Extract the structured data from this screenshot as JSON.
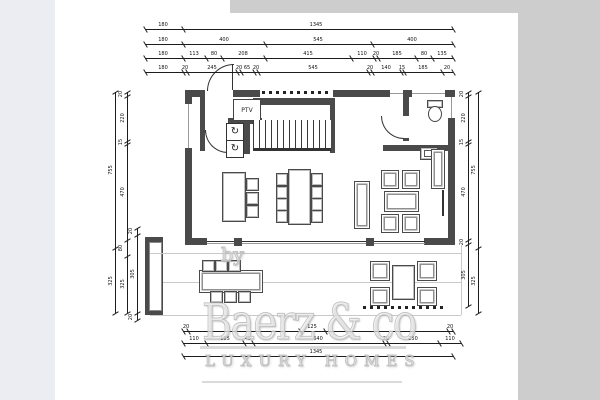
{
  "watermark": {
    "by": "by",
    "brand": "Baerz & co",
    "tagline": "LUXURY HOMES"
  },
  "plan_labels": {
    "ptv": "PTV"
  },
  "icons": {
    "appliance": "↻"
  },
  "colors": {
    "wall": "#4a4a4a",
    "paper": "#ffffff",
    "canvas": "#cdcdcd",
    "side_panel": "#ecedf2",
    "dimension": "#1c1c1c",
    "watermark": "#c2c2c2"
  },
  "dimensions": {
    "horizontal": [
      {
        "y": 29,
        "x1": 145,
        "x2": 453,
        "ticks": [
          145,
          183,
          453
        ],
        "labels": [
          {
            "x": 163,
            "t": "180"
          },
          {
            "x": 316,
            "t": "1345"
          }
        ]
      },
      {
        "y": 44,
        "x1": 145,
        "x2": 453,
        "ticks": [
          145,
          183,
          265,
          372,
          453
        ],
        "labels": [
          {
            "x": 163,
            "t": "180"
          },
          {
            "x": 224,
            "t": "400"
          },
          {
            "x": 318,
            "t": "545"
          },
          {
            "x": 412,
            "t": "400"
          }
        ]
      },
      {
        "y": 58,
        "x1": 145,
        "x2": 453,
        "ticks": [
          145,
          183,
          206,
          222,
          265,
          351,
          374,
          378,
          416,
          432,
          453
        ],
        "labels": [
          {
            "x": 163,
            "t": "180"
          },
          {
            "x": 194,
            "t": "113"
          },
          {
            "x": 214,
            "t": "80"
          },
          {
            "x": 243,
            "t": "208"
          },
          {
            "x": 308,
            "t": "415"
          },
          {
            "x": 362,
            "t": "110"
          },
          {
            "x": 376,
            "t": "20"
          },
          {
            "x": 397,
            "t": "185"
          },
          {
            "x": 424,
            "t": "80"
          },
          {
            "x": 442,
            "t": "135"
          }
        ]
      },
      {
        "y": 72,
        "x1": 145,
        "x2": 453,
        "ticks": [
          145,
          183,
          187,
          237,
          241,
          254,
          258,
          368,
          372,
          401,
          404,
          442,
          453
        ],
        "labels": [
          {
            "x": 163,
            "t": "180"
          },
          {
            "x": 185,
            "t": "20"
          },
          {
            "x": 212,
            "t": "245"
          },
          {
            "x": 239,
            "t": "20"
          },
          {
            "x": 247,
            "t": "65"
          },
          {
            "x": 256,
            "t": "20"
          },
          {
            "x": 313,
            "t": "545"
          },
          {
            "x": 370,
            "t": "20"
          },
          {
            "x": 386,
            "t": "140"
          },
          {
            "x": 402,
            "t": "15"
          },
          {
            "x": 423,
            "t": "185"
          },
          {
            "x": 447,
            "t": "20"
          }
        ]
      },
      {
        "y": 331,
        "x1": 183,
        "x2": 453,
        "ticks": [
          183,
          188,
          300,
          325,
          448,
          453
        ],
        "labels": [
          {
            "x": 186,
            "t": "20"
          },
          {
            "x": 312,
            "t": "125"
          },
          {
            "x": 450,
            "t": "20"
          }
        ]
      },
      {
        "y": 343,
        "x1": 183,
        "x2": 461,
        "ticks": [
          183,
          206,
          244,
          253,
          384,
          388,
          439,
          461
        ],
        "labels": [
          {
            "x": 194,
            "t": "110"
          },
          {
            "x": 225,
            "t": "185"
          },
          {
            "x": 248,
            "t": "45"
          },
          {
            "x": 318,
            "t": "640"
          },
          {
            "x": 386,
            "t": "20"
          },
          {
            "x": 413,
            "t": "250"
          },
          {
            "x": 450,
            "t": "110"
          }
        ]
      },
      {
        "y": 356,
        "x1": 183,
        "x2": 453,
        "ticks": [
          183,
          453
        ],
        "labels": [
          {
            "x": 316,
            "t": "1345"
          }
        ]
      }
    ],
    "vertical": [
      {
        "x": 115,
        "y1": 92,
        "y2": 313,
        "ticks": [
          92,
          248,
          313
        ],
        "labels": [
          {
            "y": 170,
            "t": "755"
          },
          {
            "y": 281,
            "t": "325"
          }
        ]
      },
      {
        "x": 127,
        "y1": 92,
        "y2": 313,
        "ticks": [
          92,
          96,
          141,
          144,
          240,
          256,
          313
        ],
        "labels": [
          {
            "y": 94,
            "t": "20"
          },
          {
            "y": 118,
            "t": "220"
          },
          {
            "y": 142,
            "t": "15"
          },
          {
            "y": 192,
            "t": "470"
          },
          {
            "y": 248,
            "t": "80"
          },
          {
            "y": 284,
            "t": "325"
          }
        ]
      },
      {
        "x": 137,
        "y1": 228,
        "y2": 320,
        "ticks": [
          228,
          235,
          313,
          320
        ],
        "labels": [
          {
            "y": 231,
            "t": "20"
          },
          {
            "y": 274,
            "t": "305"
          },
          {
            "y": 317,
            "t": "20"
          }
        ]
      },
      {
        "x": 468,
        "y1": 92,
        "y2": 306,
        "ticks": [
          92,
          96,
          141,
          144,
          240,
          244,
          306
        ],
        "labels": [
          {
            "y": 94,
            "t": "20"
          },
          {
            "y": 118,
            "t": "220"
          },
          {
            "y": 142,
            "t": "15"
          },
          {
            "y": 192,
            "t": "470"
          },
          {
            "y": 242,
            "t": "20"
          },
          {
            "y": 275,
            "t": "305"
          }
        ]
      },
      {
        "x": 478,
        "y1": 92,
        "y2": 313,
        "ticks": [
          92,
          248,
          313
        ],
        "labels": [
          {
            "y": 170,
            "t": "755"
          },
          {
            "y": 281,
            "t": "325"
          }
        ]
      }
    ]
  }
}
